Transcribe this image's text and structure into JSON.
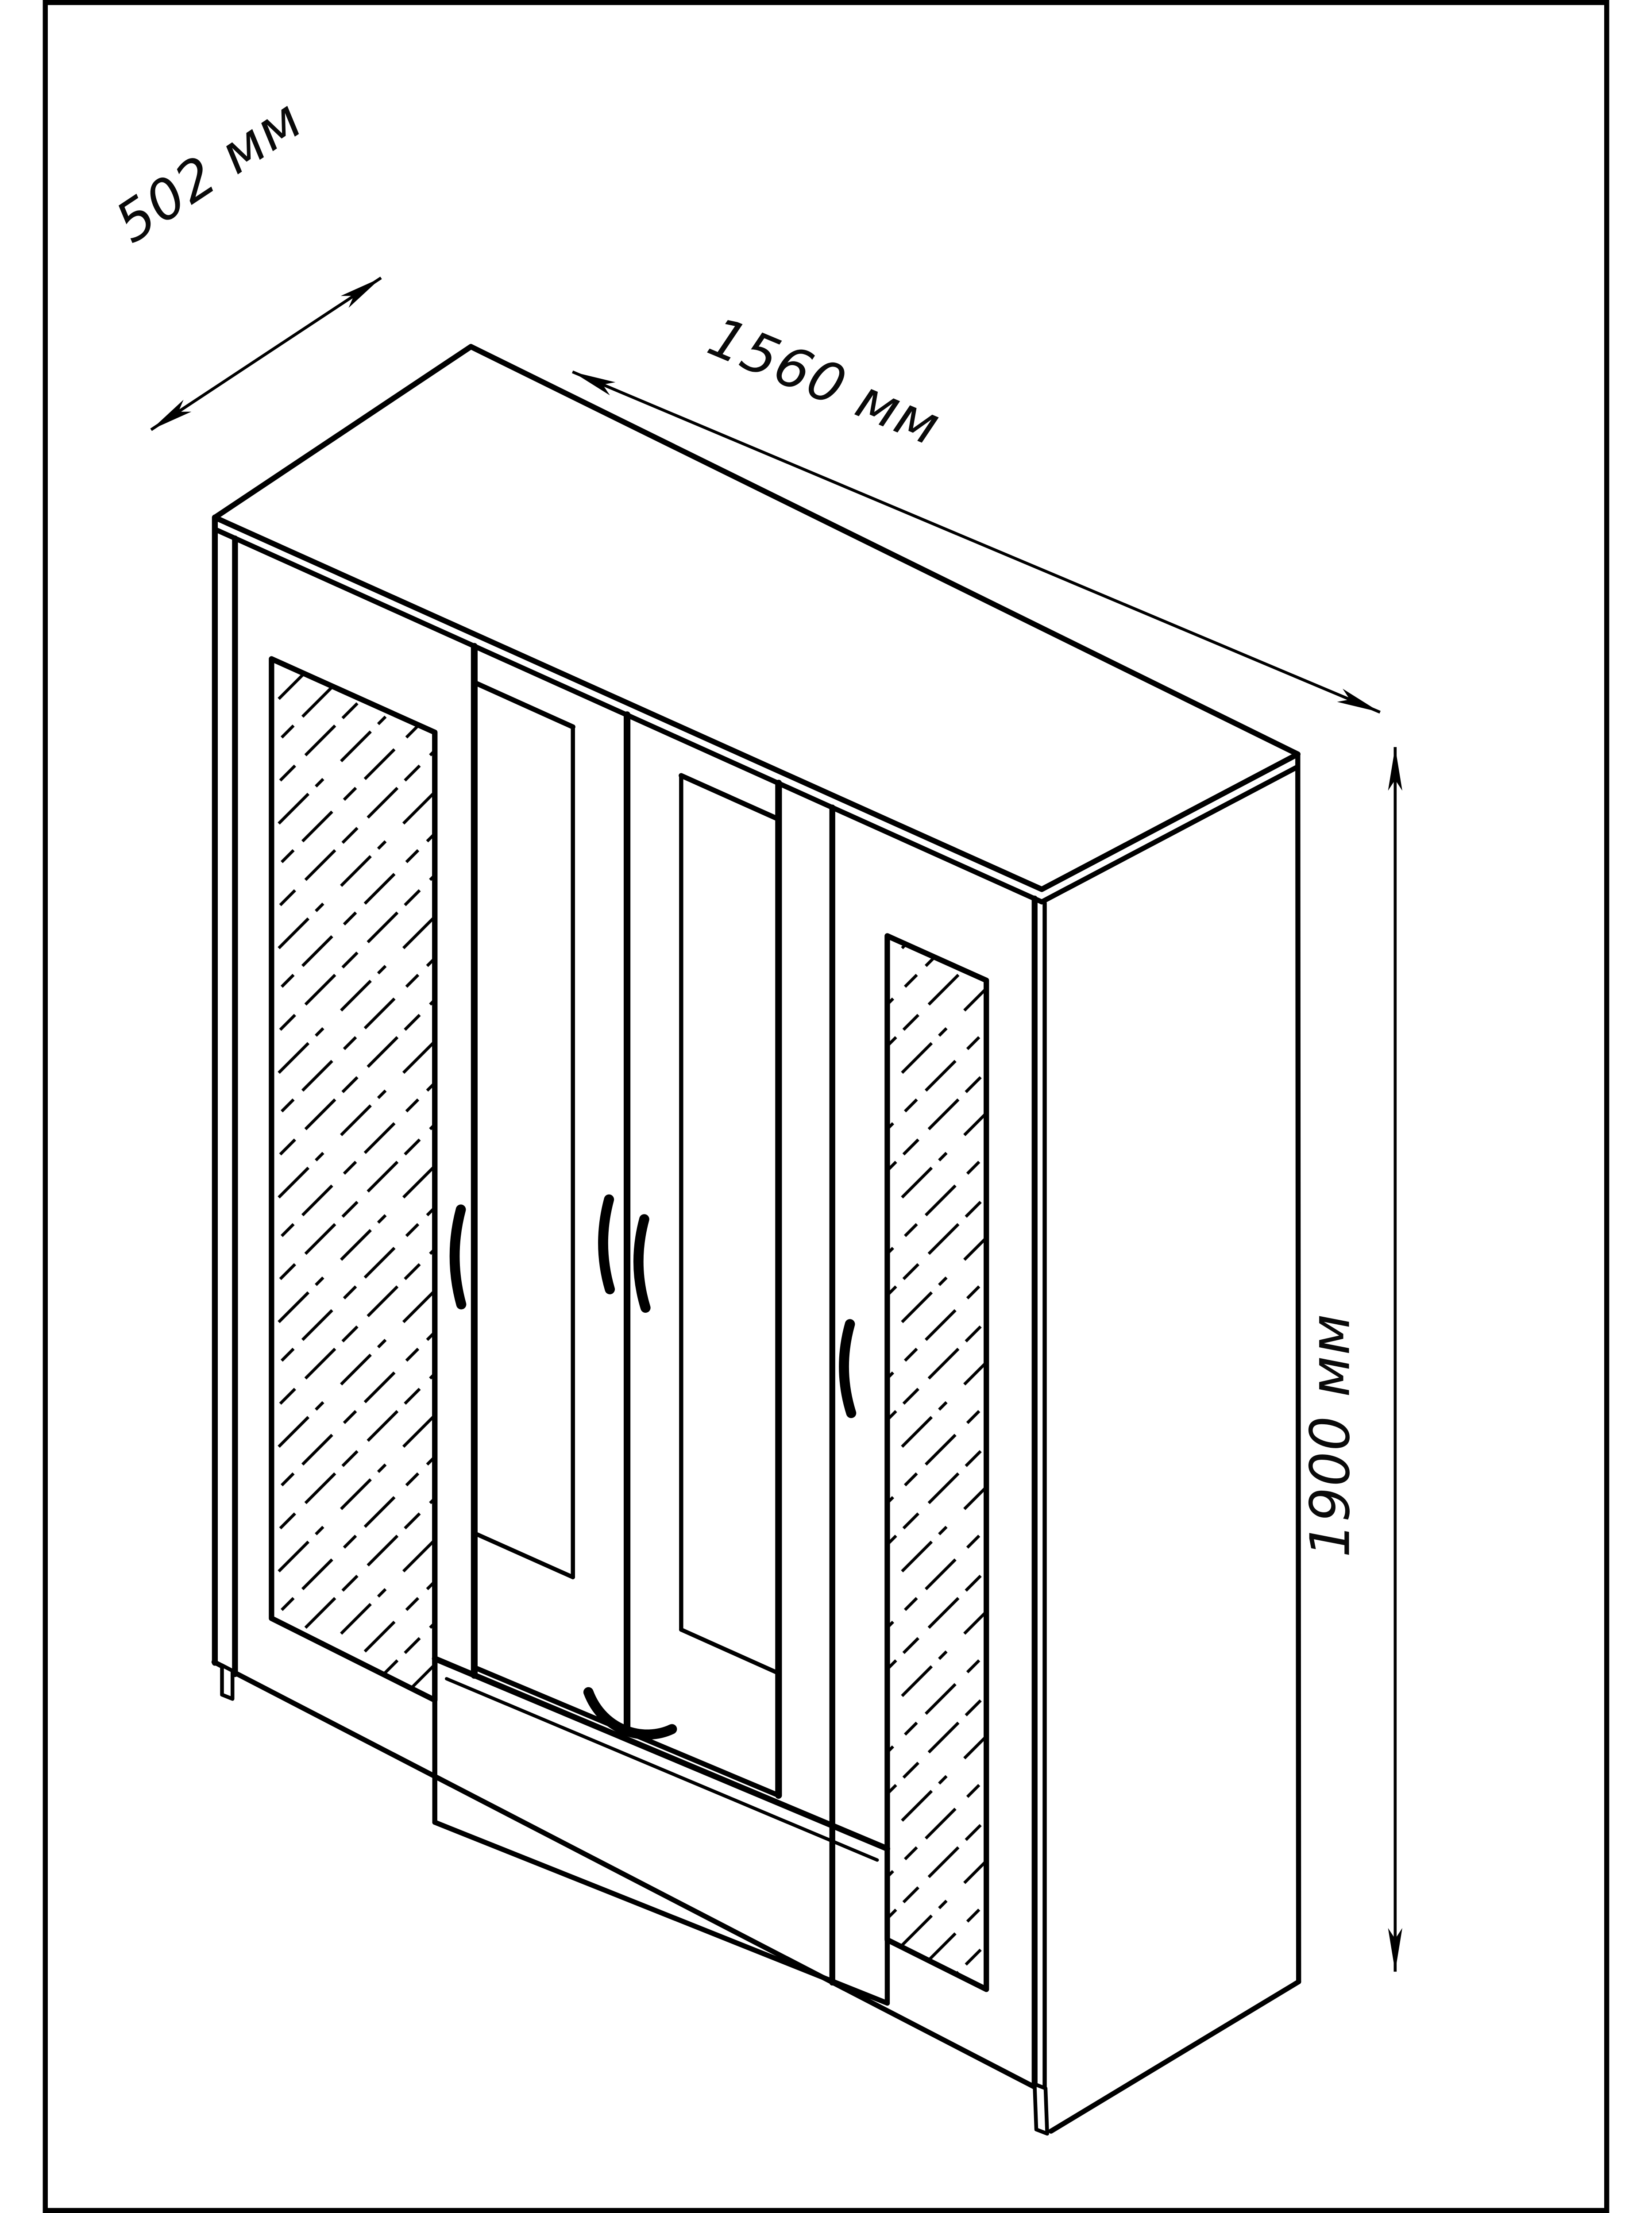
{
  "diagram": {
    "type": "furniture-technical-drawing",
    "subject": "Four-door wardrobe with two mirrored doors and one bottom drawer, isometric line drawing",
    "background_color": "#ffffff",
    "line_color": "#000000",
    "unit": "мм",
    "dimensions": {
      "depth": {
        "value": 502,
        "label": "502 мм"
      },
      "width": {
        "value": 1560,
        "label": "1560 мм"
      },
      "height": {
        "value": 1900,
        "label": "1900 мм"
      }
    }
  }
}
